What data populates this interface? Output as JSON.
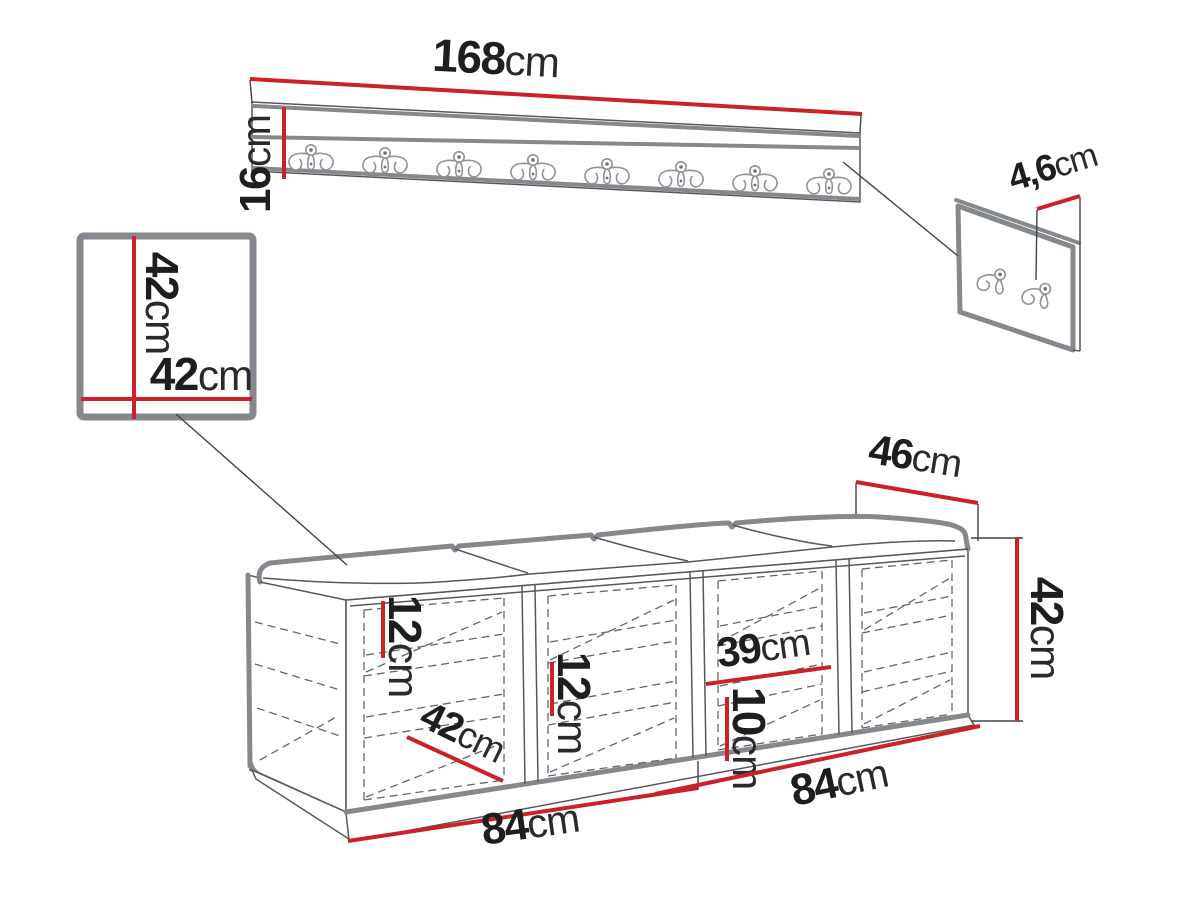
{
  "diagram_title": "Hallway furniture set dimension drawing",
  "dims": {
    "rack_length": {
      "v": "168",
      "u": "cm"
    },
    "rack_height": {
      "v": "16",
      "u": "cm"
    },
    "panel_height": {
      "v": "42",
      "u": "cm"
    },
    "panel_width": {
      "v": "42",
      "u": "cm"
    },
    "hook_board_depth": {
      "v": "4,6",
      "u": "cm"
    },
    "bench_depth": {
      "v": "46",
      "u": "cm"
    },
    "bench_height": {
      "v": "42",
      "u": "cm"
    },
    "shelf_gap_1": {
      "v": "12",
      "u": "cm"
    },
    "shelf_gap_2": {
      "v": "12",
      "u": "cm"
    },
    "niche_width": {
      "v": "39",
      "u": "cm"
    },
    "bottom_gap": {
      "v": "10",
      "u": "cm"
    },
    "shelf_diagonal": {
      "v": "42",
      "u": "cm"
    },
    "bench_half_left": {
      "v": "84",
      "u": "cm"
    },
    "bench_half_right": {
      "v": "84",
      "u": "cm"
    }
  },
  "counts": {
    "rack_hooks": 8,
    "board_hooks": 2,
    "bench_compartments": 4,
    "cushion_sections": 4
  },
  "colors": {
    "dimension_red": "#cc2128",
    "outline_gray": "#85898d",
    "line_dark": "#55585c",
    "text": "#1e1e20",
    "background": "#ffffff"
  }
}
